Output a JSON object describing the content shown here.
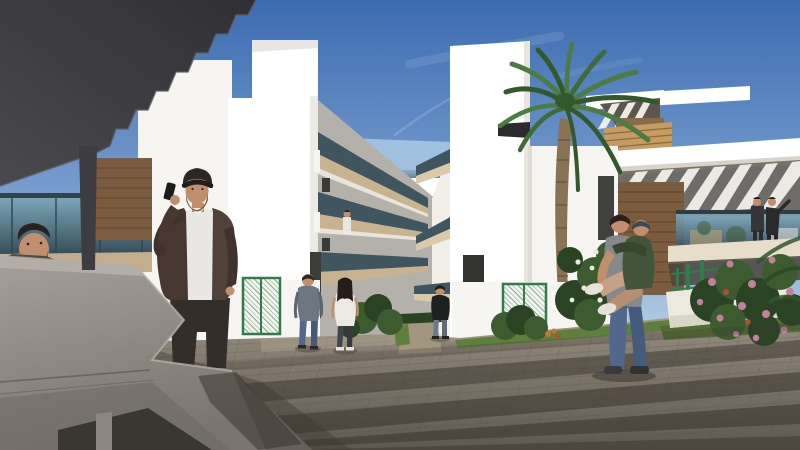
{
  "scene": {
    "kind": "architectural-3d-render",
    "elements": [
      "sky",
      "cloud-streaks",
      "dark-pergola-canopy",
      "canopy-support-pillar",
      "left-villa-terrace-glass",
      "left-villa-wood-wall",
      "left-apartment-block",
      "left-tower",
      "corridor-left-balconies",
      "pedestrian-bridge",
      "far-staircase",
      "corridor-right-balconies",
      "right-apartment-block",
      "right-tower",
      "palm-tree",
      "right-villa-roof-pergola",
      "right-villa-wood-wall",
      "right-villa-terrace",
      "terrace-couple",
      "paved-plaza",
      "paver-shadow-stripes",
      "concrete-bench",
      "man-peeking-behind-bench",
      "man-on-phone",
      "man-grey-hoodie",
      "woman-white-top",
      "man-black-tshirt",
      "balcony-resident",
      "father-piggyback-child",
      "green-mesh-gate",
      "flower-shrubs",
      "grass-strips"
    ]
  },
  "colors": {
    "sky_top": "#3b6bb0",
    "sky_mid": "#7ba0d0",
    "sky_low": "#b9d2e6",
    "sky_horizon": "#d8e5ef",
    "canopy_dark": "#303034",
    "canopy_light": "#4a4a4e",
    "pillar": "#3d3d41",
    "white_pure": "#ffffff",
    "white_lit": "#f7f5f1",
    "white_shade": "#e4e1db",
    "wall_shadow": "#b4b1ab",
    "far_wall": "#e3dfd9",
    "soffit_beige": "#c9b28e",
    "soffit_light": "#dcc9a8",
    "glass_dark": "#3f5560",
    "glass_teal": "#7fa9bb",
    "glass_deep": "#2e4450",
    "wood_dark": "#7b5c3e",
    "wood_light": "#c59c62",
    "pavement_lit": "#9a9081",
    "pavement_dark": "#5a544c",
    "pavement_lit_overlay": "#b3a68e",
    "shadow_stripe": "#3b352d",
    "bench_top": "#a19c95",
    "bench_bottom": "#6f6a63",
    "bench_dark": "#3a3631",
    "grass": "#5f7f3c",
    "bush_green": "#3c5c30",
    "bush_dark": "#2a4423",
    "palm_green": "#4d7c42",
    "palm_dark": "#33582c",
    "trunk": "#8a7355",
    "flower_pink": "#c4819f",
    "flower_red": "#b84a32",
    "flower_white": "#eae6d8",
    "flower_orange": "#c9762e",
    "fence_green": "#2f7d4b",
    "skin": "#c18f6d",
    "beard": "#7a5436",
    "man_cap": "#2a2724",
    "man_jacket": "#483730",
    "man_tee": "#e9e7e3",
    "man_pants": "#332e29",
    "jeans_blue": "#51688c",
    "tee_gray": "#85898a",
    "tee_white": "#ece9e4",
    "tee_black": "#1f2022",
    "hoodie_gray": "#6d7683",
    "child_green": "#42543a",
    "shoe_white": "#e6e2d8",
    "hair_dark": "#241d18",
    "jacket_olive": "#4a4f42"
  }
}
